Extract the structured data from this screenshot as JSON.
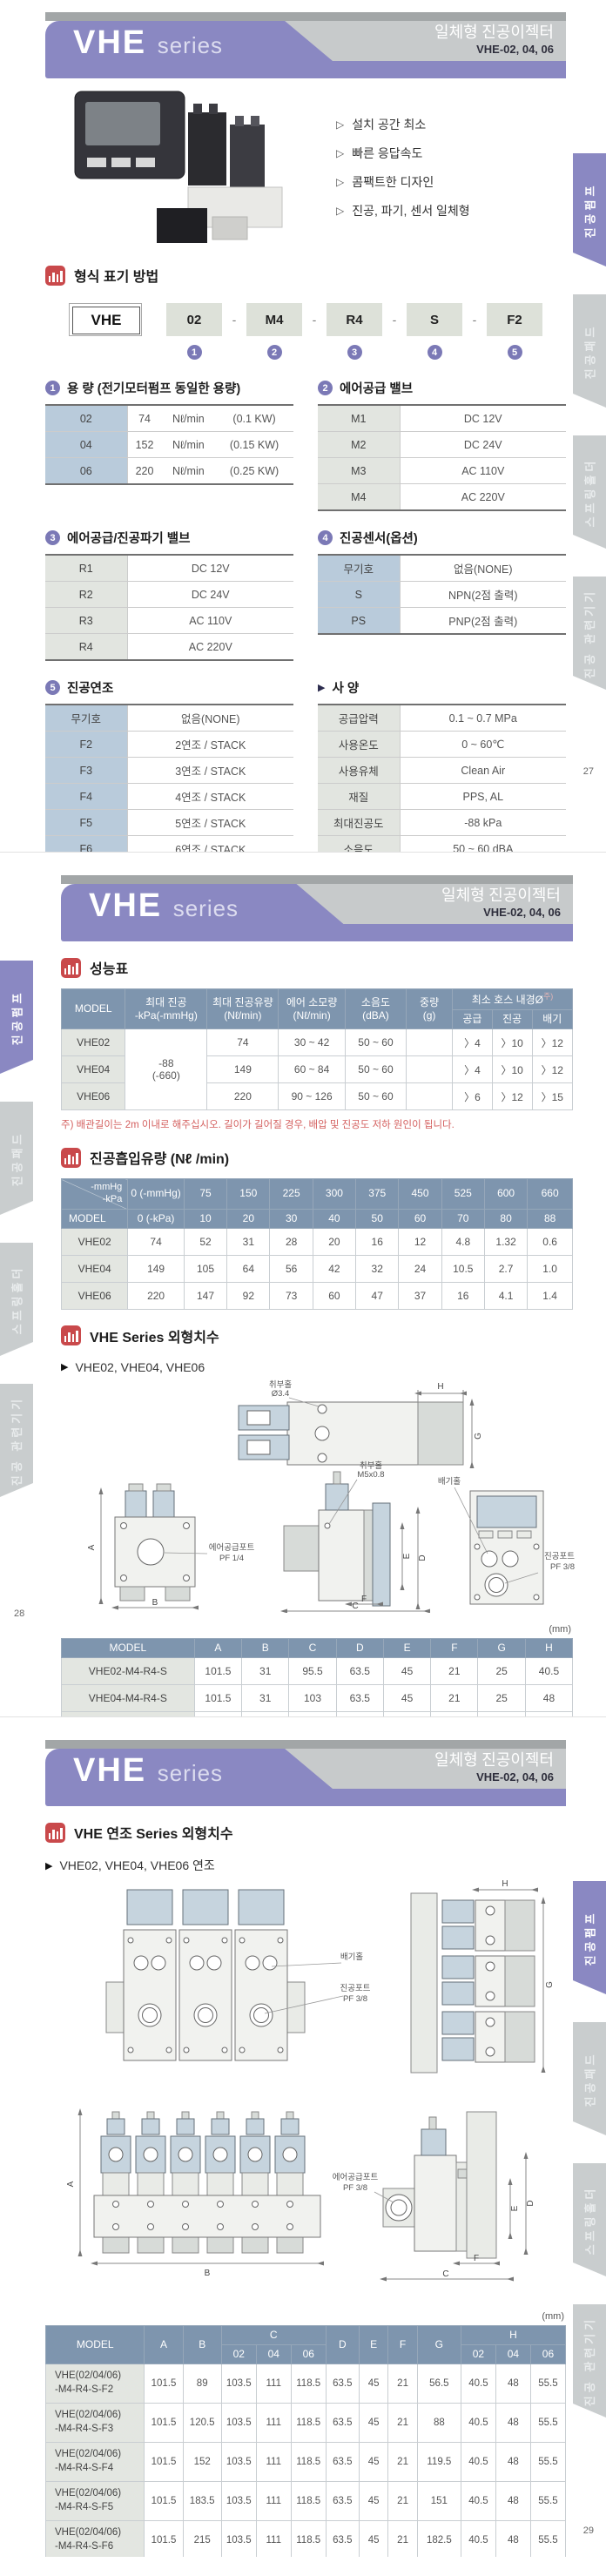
{
  "banner": {
    "series": "VHE",
    "series_sub": "series",
    "product": "일체형 진공이젝터",
    "models": "VHE-02, 04, 06"
  },
  "markers": {
    "feature": "▷",
    "arrow": "▶",
    "dash": "-"
  },
  "colors": {
    "accent_purple": "#8a88c2",
    "table_header_blue": "#7e95ae",
    "label_cell_blue": "#b9cbdb",
    "section_icon_red": "#c9494b"
  },
  "tabs": {
    "items": [
      {
        "label": "진공펌프",
        "active": true
      },
      {
        "label": "진공패드",
        "active": false
      },
      {
        "label": "스프링홀더",
        "active": false
      },
      {
        "label": "진공 관련기기",
        "active": false
      }
    ]
  },
  "p1": {
    "features": [
      "설치 공간 최소",
      "빠른 응답속도",
      "콤팩트한 디자인",
      "진공, 파기, 센서 일체형"
    ],
    "model_section": {
      "title": "형식 표기 방법",
      "boxes": [
        "VHE",
        "02",
        "M4",
        "R4",
        "S",
        "F2"
      ],
      "nums": [
        "1",
        "2",
        "3",
        "4",
        "5"
      ]
    },
    "capacity": {
      "num": "1",
      "title": "용 량 (전기모터펌프 동일한 용량)",
      "rows": [
        [
          "02",
          "74",
          "Nℓ/min",
          "(0.1 KW)"
        ],
        [
          "04",
          "152",
          "Nℓ/min",
          "(0.15 KW)"
        ],
        [
          "06",
          "220",
          "Nℓ/min",
          "(0.25 KW)"
        ]
      ]
    },
    "supply_valve": {
      "num": "2",
      "title": "에어공급 밸브",
      "rows": [
        [
          "M1",
          "DC 12V"
        ],
        [
          "M2",
          "DC 24V"
        ],
        [
          "M3",
          "AC 110V"
        ],
        [
          "M4",
          "AC 220V"
        ]
      ]
    },
    "break_valve": {
      "num": "3",
      "title": "에어공급/진공파기 밸브",
      "rows": [
        [
          "R1",
          "DC 12V"
        ],
        [
          "R2",
          "DC 24V"
        ],
        [
          "R3",
          "AC 110V"
        ],
        [
          "R4",
          "AC 220V"
        ]
      ]
    },
    "sensor": {
      "num": "4",
      "title": "진공센서(옵션)",
      "rows": [
        [
          "무기호",
          "없음(NONE)"
        ],
        [
          "S",
          "NPN(2점 출력)"
        ],
        [
          "PS",
          "PNP(2점 출력)"
        ]
      ]
    },
    "stack": {
      "num": "5",
      "title": "진공연조",
      "rows": [
        [
          "무기호",
          "없음(NONE)"
        ],
        [
          "F2",
          "2연조 / STACK"
        ],
        [
          "F3",
          "3연조 / STACK"
        ],
        [
          "F4",
          "4연조 / STACK"
        ],
        [
          "F5",
          "5연조 / STACK"
        ],
        [
          "F6",
          "6연조 / STACK"
        ]
      ]
    },
    "spec": {
      "title": "사 양",
      "rows": [
        [
          "공급압력",
          "0.1 ~ 0.7 MPa"
        ],
        [
          "사용온도",
          "0 ~ 60℃"
        ],
        [
          "사용유체",
          "Clean Air"
        ],
        [
          "재질",
          "PPS, AL"
        ],
        [
          "최대진공도",
          "-88 kPa"
        ],
        [
          "소음도",
          "50 ~ 60 dBA"
        ]
      ]
    },
    "footnote": "※진공필터장착 권장 (VDF38, VLF38)",
    "page_no": "27"
  },
  "p2": {
    "perf": {
      "title": "성능표",
      "h": {
        "model": "MODEL",
        "vac": "최대 진공\n-kPa(-mmHg)",
        "flow": "최대 진공유량\n(Nℓ/min)",
        "air": "에어 소모량\n(Nℓ/min)",
        "noise": "소음도\n(dBA)",
        "weight": "중량\n(g)",
        "hose": "최소 호스 내경Ø",
        "hose_note": "주)",
        "subs": [
          "공급",
          "진공",
          "배기"
        ]
      },
      "r0": [
        "VHE02",
        "-88\n(-660)",
        "74",
        "30 ~ 42",
        "50 ~ 60",
        "",
        "〉4",
        "〉10",
        "〉12"
      ],
      "r1": [
        "VHE04",
        "149",
        "60 ~ 84",
        "50 ~ 60",
        "",
        "〉4",
        "〉10",
        "〉12"
      ],
      "r2": [
        "VHE06",
        "220",
        "90 ~ 126",
        "50 ~ 60",
        "",
        "〉6",
        "〉12",
        "〉15"
      ],
      "note": "주) 배관길이는 2m 이내로 해주십시오. 길이가 길어질 경우, 배압 및 진공도 저하 원인이 됩니다."
    },
    "flow": {
      "title": "진공흡입유량 (Nℓ /min)",
      "corner": "-mmHg\n-kPa",
      "model_label": "MODEL",
      "h1": [
        "0 (-mmHg)",
        "75",
        "150",
        "225",
        "300",
        "375",
        "450",
        "525",
        "600",
        "660"
      ],
      "h2": [
        "0 (-kPa)",
        "10",
        "20",
        "30",
        "40",
        "50",
        "60",
        "70",
        "80",
        "88"
      ],
      "rows": [
        [
          "VHE02",
          "74",
          "52",
          "31",
          "28",
          "20",
          "16",
          "12",
          "4.8",
          "1.32",
          "0.6"
        ],
        [
          "VHE04",
          "149",
          "105",
          "64",
          "56",
          "42",
          "32",
          "24",
          "10.5",
          "2.7",
          "1.0"
        ],
        [
          "VHE06",
          "220",
          "147",
          "92",
          "73",
          "60",
          "47",
          "37",
          "16",
          "4.1",
          "1.4"
        ]
      ]
    },
    "dims": {
      "title": "VHE Series 외형치수",
      "subtitle": "VHE02, VHE04, VHE06",
      "unit": "(mm)",
      "headers": [
        "MODEL",
        "A",
        "B",
        "C",
        "D",
        "E",
        "F",
        "G",
        "H"
      ],
      "rows": [
        [
          "VHE02-M4-R4-S",
          "101.5",
          "31",
          "95.5",
          "63.5",
          "45",
          "21",
          "25",
          "40.5"
        ],
        [
          "VHE04-M4-R4-S",
          "101.5",
          "31",
          "103",
          "63.5",
          "45",
          "21",
          "25",
          "48"
        ],
        [
          "VHE06-M4-R4-S",
          "101.5",
          "31",
          "110.5",
          "63.5",
          "45",
          "21",
          "25",
          "55.5"
        ]
      ]
    },
    "draw": {
      "mount_hole": "취부홀",
      "mount_hole_dia": "Ø3.4",
      "mount_hole2": "취부홀",
      "mount_hole2_size": "M5x0.8",
      "supply": "에어공급포트",
      "supply_size": "PF 1/4",
      "exhaust": "배기홀",
      "vacuum": "진공포트",
      "vacuum_size": "PF 3/8",
      "A": "A",
      "B": "B",
      "C": "C",
      "D": "D",
      "E": "E",
      "F": "F",
      "G": "G",
      "H": "H"
    },
    "page_no": "28"
  },
  "p3": {
    "section": {
      "title": "VHE 연조 Series 외형치수",
      "subtitle": "VHE02, VHE04, VHE06 연조"
    },
    "draw": {
      "exhaust": "배기홀",
      "vacuum": "진공포트",
      "vacuum_size": "PF 3/8",
      "supply": "에어공급포트",
      "supply_size": "PF 3/8",
      "A": "A",
      "B": "B",
      "C": "C",
      "D": "D",
      "E": "E",
      "F": "F",
      "G": "G",
      "H": "H"
    },
    "table": {
      "h": [
        "MODEL",
        "A",
        "B",
        "C",
        "D",
        "E",
        "F",
        "G",
        "H"
      ],
      "subs": [
        "02",
        "04",
        "06",
        "02",
        "04",
        "06"
      ],
      "unit": "(mm)",
      "rows": [
        [
          "VHE(02/04/06)\n-M4-R4-S-F2",
          "101.5",
          "89",
          "103.5",
          "111",
          "118.5",
          "63.5",
          "45",
          "21",
          "56.5",
          "40.5",
          "48",
          "55.5"
        ],
        [
          "VHE(02/04/06)\n-M4-R4-S-F3",
          "101.5",
          "120.5",
          "103.5",
          "111",
          "118.5",
          "63.5",
          "45",
          "21",
          "88",
          "40.5",
          "48",
          "55.5"
        ],
        [
          "VHE(02/04/06)\n-M4-R4-S-F4",
          "101.5",
          "152",
          "103.5",
          "111",
          "118.5",
          "63.5",
          "45",
          "21",
          "119.5",
          "40.5",
          "48",
          "55.5"
        ],
        [
          "VHE(02/04/06)\n-M4-R4-S-F5",
          "101.5",
          "183.5",
          "103.5",
          "111",
          "118.5",
          "63.5",
          "45",
          "21",
          "151",
          "40.5",
          "48",
          "55.5"
        ],
        [
          "VHE(02/04/06)\n-M4-R4-S-F6",
          "101.5",
          "215",
          "103.5",
          "111",
          "118.5",
          "63.5",
          "45",
          "21",
          "182.5",
          "40.5",
          "48",
          "55.5"
        ]
      ]
    },
    "page_no": "29"
  }
}
